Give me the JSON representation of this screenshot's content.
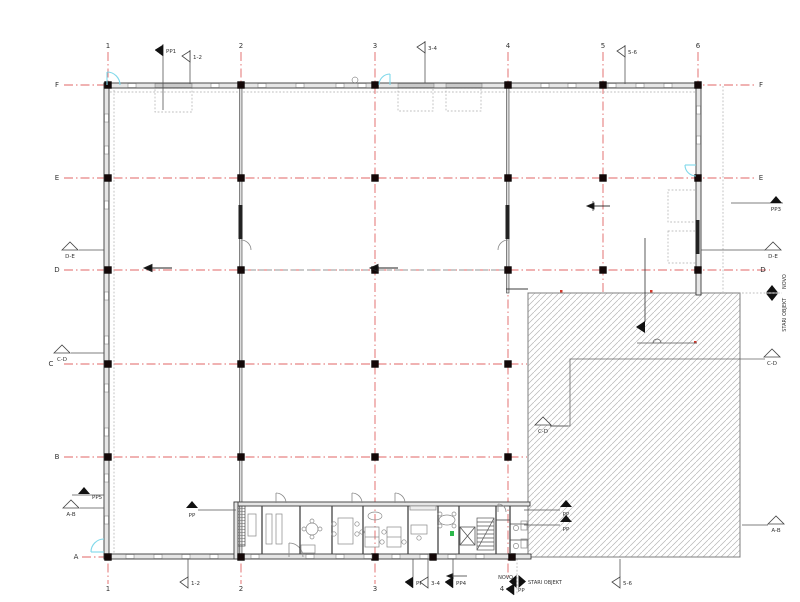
{
  "plan": {
    "grid_labels": {
      "top": [
        [
          "1",
          108
        ],
        [
          "2",
          241
        ],
        [
          "3",
          375
        ],
        [
          "4",
          508
        ],
        [
          "5",
          603
        ],
        [
          "6",
          698
        ]
      ],
      "bottom": [
        [
          "1",
          108
        ],
        [
          "2",
          241
        ],
        [
          "3",
          375
        ],
        [
          "4",
          502
        ]
      ],
      "left": [
        [
          "F",
          57,
          87
        ],
        [
          "E",
          57,
          180
        ],
        [
          "D",
          57,
          272
        ],
        [
          "C",
          51,
          366
        ],
        [
          "B",
          57,
          459
        ],
        [
          "A",
          76,
          559
        ]
      ],
      "right": [
        [
          "F",
          761,
          87
        ],
        [
          "E",
          761,
          180
        ],
        [
          "D",
          763,
          272
        ]
      ]
    },
    "grid_lines": {
      "v": [
        [
          108,
          52,
          584
        ],
        [
          241,
          52,
          584
        ],
        [
          375,
          52,
          584
        ],
        [
          508,
          52,
          577
        ],
        [
          603,
          52,
          294
        ],
        [
          698,
          52,
          294
        ]
      ],
      "h": [
        [
          85,
          64,
          757
        ],
        [
          178,
          64,
          757
        ],
        [
          270,
          64,
          770
        ],
        [
          364,
          64,
          527
        ],
        [
          457,
          64,
          527
        ],
        [
          557,
          82,
          514
        ]
      ]
    },
    "columns": [
      [
        108,
        85
      ],
      [
        241,
        85
      ],
      [
        375,
        85
      ],
      [
        508,
        85
      ],
      [
        603,
        85
      ],
      [
        698,
        85
      ],
      [
        108,
        178
      ],
      [
        241,
        178
      ],
      [
        375,
        178
      ],
      [
        508,
        178
      ],
      [
        603,
        178
      ],
      [
        698,
        178
      ],
      [
        108,
        270
      ],
      [
        241,
        270
      ],
      [
        375,
        270
      ],
      [
        508,
        270
      ],
      [
        603,
        270
      ],
      [
        698,
        270
      ],
      [
        108,
        364
      ],
      [
        241,
        364
      ],
      [
        375,
        364
      ],
      [
        508,
        364
      ],
      [
        108,
        457
      ],
      [
        241,
        457
      ],
      [
        375,
        457
      ],
      [
        508,
        457
      ],
      [
        108,
        557
      ],
      [
        241,
        557
      ],
      [
        375,
        557
      ],
      [
        433,
        557
      ],
      [
        512,
        557
      ]
    ],
    "windows": {
      "top": [
        132,
        215,
        262,
        300,
        340,
        362,
        545,
        572,
        612,
        640,
        668
      ],
      "left": [
        118,
        150,
        205,
        296,
        340,
        388,
        432,
        478,
        520
      ],
      "bottom": [
        130,
        158,
        186,
        214,
        255,
        310,
        340,
        368,
        396,
        424,
        452,
        480
      ],
      "right": [
        110,
        140
      ]
    },
    "red_dots": [
      [
        560,
        290
      ],
      [
        650,
        290
      ],
      [
        694,
        341
      ]
    ],
    "markers": [
      {
        "t": "cone",
        "l": "1-2",
        "x": 190,
        "y": 57,
        "line": [
          190,
          50,
          190,
          84
        ],
        "lx": 193,
        "ly": 59,
        "a": "start"
      },
      {
        "t": "flag",
        "l": "PP1",
        "x": 163,
        "y": 51,
        "line": [
          163,
          44,
          163,
          110
        ],
        "lx": 166,
        "ly": 53,
        "a": "start"
      },
      {
        "t": "cone",
        "l": "3-4",
        "x": 425,
        "y": 48,
        "line": [
          425,
          41,
          425,
          83
        ],
        "lx": 428,
        "ly": 50,
        "a": "start"
      },
      {
        "t": "cone",
        "l": "5-6",
        "x": 625,
        "y": 52,
        "line": [
          625,
          45,
          625,
          84
        ],
        "lx": 628,
        "ly": 54,
        "a": "start"
      },
      {
        "t": "cone",
        "l": "1-2",
        "x": 188,
        "y": 583,
        "line": [
          188,
          559,
          188,
          577
        ],
        "lx": 191,
        "ly": 585,
        "a": "start"
      },
      {
        "t": "flag",
        "l": "PP2",
        "x": 413,
        "y": 583,
        "line": [
          413,
          559,
          413,
          577
        ],
        "lx": 416,
        "ly": 585,
        "a": "start"
      },
      {
        "t": "cone",
        "l": "3-4",
        "x": 428,
        "y": 583,
        "line": [
          428,
          559,
          428,
          577
        ],
        "lx": 431,
        "ly": 585,
        "a": "start"
      },
      {
        "t": "flag",
        "l": "PP4",
        "x": 453,
        "y": 583,
        "line": [
          453,
          559,
          453,
          577
        ],
        "lx": 456,
        "ly": 585,
        "a": "start"
      },
      {
        "t": "flag",
        "l": "PP",
        "x": 514,
        "y": 590,
        "lx": 518,
        "ly": 592,
        "a": "start"
      },
      {
        "t": "cone",
        "l": "5-6",
        "x": 620,
        "y": 583,
        "line": [
          620,
          559,
          620,
          577
        ],
        "lx": 623,
        "ly": 585,
        "a": "start"
      },
      {
        "t": "gflag",
        "l": "PP3",
        "x": 776,
        "y": 199,
        "line": [
          731,
          203,
          783,
          203
        ],
        "lx": 776,
        "ly": 211,
        "a": "middle"
      },
      {
        "t": "gflag",
        "l": "PP5",
        "x": 84,
        "y": 490,
        "line": [
          72,
          495,
          104,
          495
        ],
        "lx": 92,
        "ly": 499,
        "a": "start"
      },
      {
        "t": "gflag",
        "l": "PP",
        "x": 192,
        "y": 504,
        "line": [
          198,
          510,
          236,
          510
        ],
        "lx": 192,
        "ly": 517,
        "a": "middle"
      },
      {
        "t": "gflag",
        "l": "PP",
        "x": 566,
        "y": 503,
        "line": [
          524,
          510,
          560,
          510
        ],
        "lx": 566,
        "ly": 516,
        "a": "middle"
      },
      {
        "t": "gflag",
        "l": "PP",
        "x": 566,
        "y": 518,
        "line": [
          524,
          525,
          560,
          525
        ],
        "lx": 566,
        "ly": 531,
        "a": "middle"
      },
      {
        "t": "gable",
        "l": "D-E",
        "x": 70,
        "y": 246,
        "line": [
          79,
          250,
          104,
          250
        ],
        "lx": 70,
        "ly": 258,
        "a": "middle"
      },
      {
        "t": "gable",
        "l": "C-D",
        "x": 62,
        "y": 349,
        "line": [
          71,
          353,
          104,
          353
        ],
        "lx": 62,
        "ly": 361,
        "a": "middle"
      },
      {
        "t": "gable",
        "l": "A-B",
        "x": 71,
        "y": 504,
        "line": [
          80,
          508,
          104,
          508
        ],
        "lx": 71,
        "ly": 516,
        "a": "middle"
      },
      {
        "t": "gable",
        "l": "D-E",
        "x": 773,
        "y": 246,
        "line": [
          701,
          250,
          765,
          250
        ],
        "lx": 773,
        "ly": 258,
        "a": "middle"
      },
      {
        "t": "gable",
        "l": "C-D",
        "x": 772,
        "y": 353,
        "lx": 772,
        "ly": 365,
        "a": "middle"
      },
      {
        "t": "gable",
        "l": "A-B",
        "x": 776,
        "y": 520,
        "line": [
          742,
          525,
          768,
          525
        ],
        "lx": 776,
        "ly": 532,
        "a": "middle"
      },
      {
        "t": "gable",
        "l": "C-D",
        "x": 543,
        "y": 421,
        "line": [
          550,
          426,
          568,
          426
        ],
        "lx": 543,
        "ly": 433,
        "a": "middle"
      }
    ],
    "joint": {
      "novo": "NOVO",
      "stari": "STARI OBJEKT"
    },
    "colors": {
      "grid": "#e06464",
      "wall_stroke": "#3c3c3c",
      "wall_fill": "#e6e6e6",
      "column": "#140808",
      "hatch": "#b5b5b5",
      "door": "#7fd8ea",
      "exit_green": "#2db84b",
      "red_dot": "#d33a2e"
    }
  }
}
